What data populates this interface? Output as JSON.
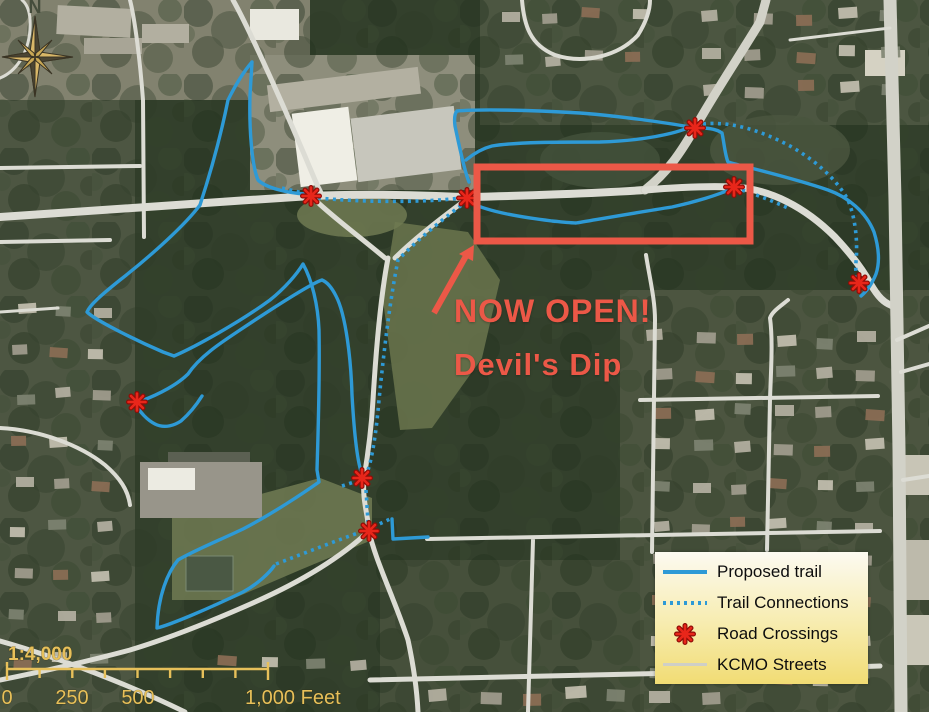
{
  "annotations": {
    "now_open": "NOW OPEN!",
    "trail_name": "Devil's Dip"
  },
  "compass": {
    "label": "N"
  },
  "scale_bar": {
    "ratio": "1:4,000",
    "tick_labels": [
      "0",
      "250",
      "500"
    ],
    "end_label": "1,000 Feet"
  },
  "legend": {
    "items": [
      {
        "label": "Proposed trail",
        "swatch": "solid-blue-line"
      },
      {
        "label": "Trail Connections",
        "swatch": "dotted-blue-line"
      },
      {
        "label": "Road Crossings",
        "swatch": "red-asterisk"
      },
      {
        "label": "KCMO Streets",
        "swatch": "gray-line"
      }
    ]
  },
  "map": {
    "road_crossing_count": 8,
    "highlighted_feature": "Devil's Dip trail segment"
  },
  "colors": {
    "proposed_trail_blue": "#2e9ad6",
    "highlight_red": "#ec5847",
    "crossing_red": "#e8261a",
    "scale_gold": "#e7c05a",
    "street_gray": "#dcdcd4"
  }
}
